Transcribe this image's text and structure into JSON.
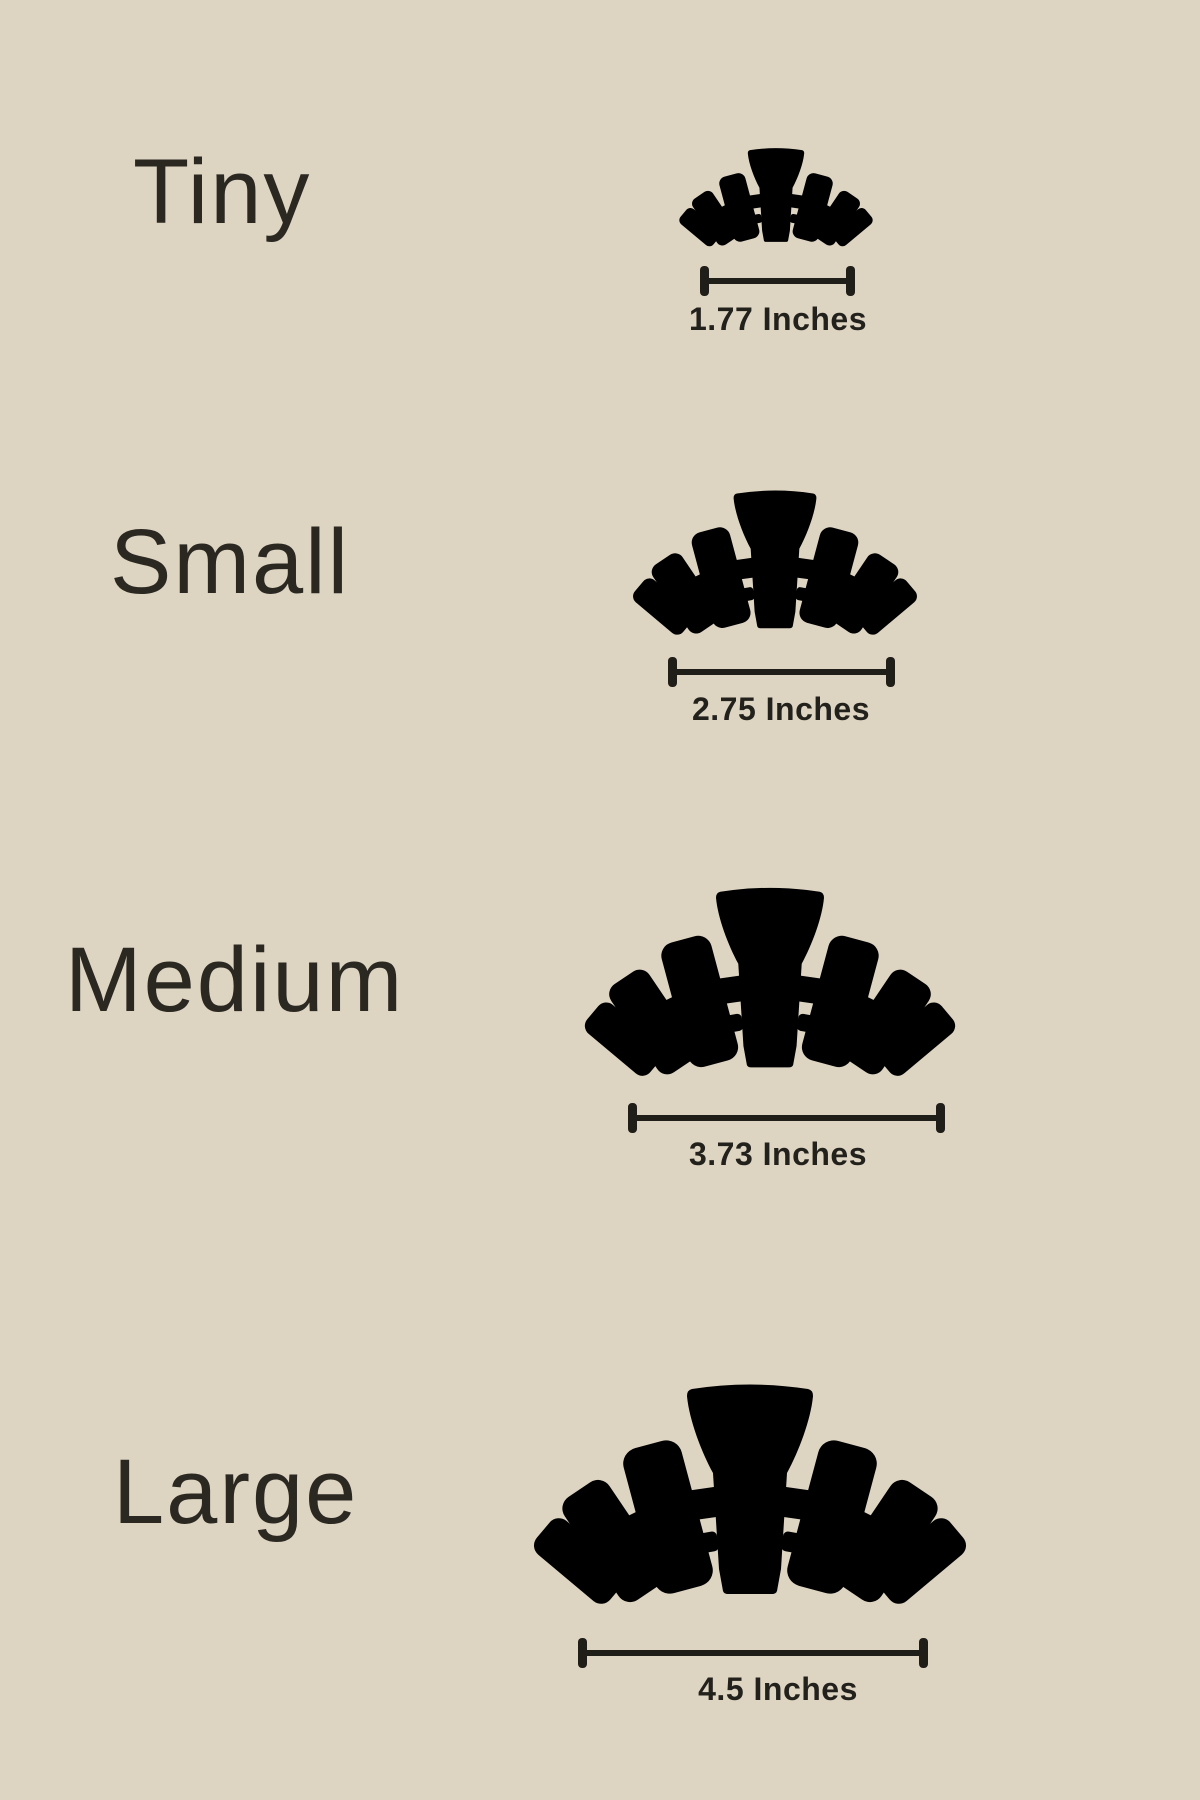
{
  "page": {
    "background_color": "#ddd4c2",
    "ink_color": "#2c2a24",
    "bar_color": "#201e19",
    "description": "Claw clip size chart"
  },
  "icons": {
    "clip": "claw-clip-icon"
  },
  "rows": [
    {
      "id": "tiny",
      "label": "Tiny",
      "measurement": "1.77 Inches"
    },
    {
      "id": "small",
      "label": "Small",
      "measurement": "2.75 Inches"
    },
    {
      "id": "medium",
      "label": "Medium",
      "measurement": "3.73 Inches"
    },
    {
      "id": "large",
      "label": "Large",
      "measurement": "4.5 Inches"
    }
  ]
}
